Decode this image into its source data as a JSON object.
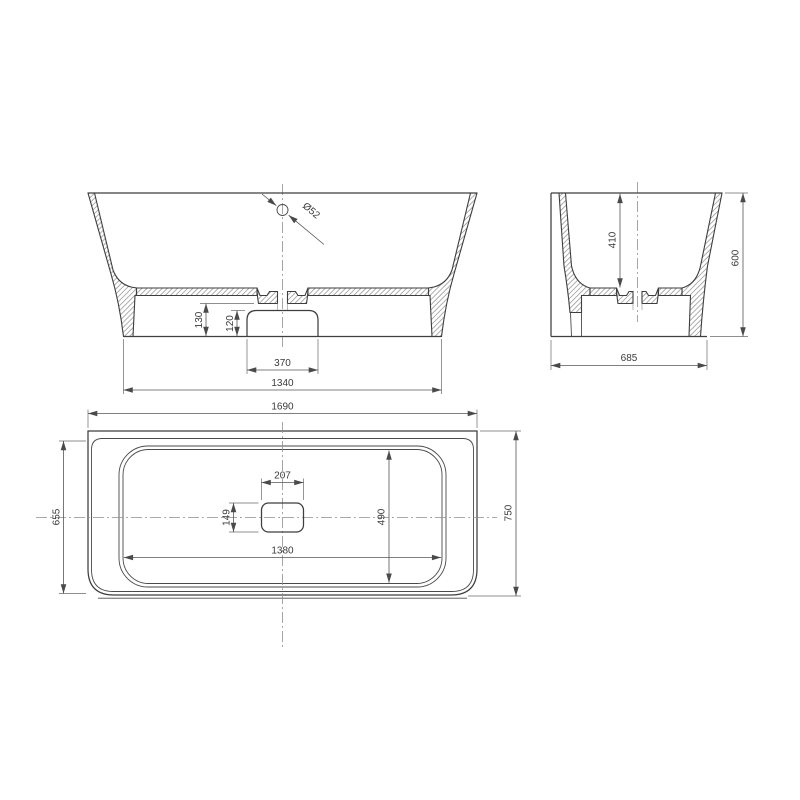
{
  "drawing": {
    "type": "bathtub-three-view-technical-drawing",
    "colors": {
      "line": "#3e3e3e",
      "dimension_line": "#555555",
      "centerline": "#8f8f8f",
      "plan_fill": "#e8eae9",
      "basin_fill": "#eceeed",
      "background": "#ffffff"
    },
    "front_view": {
      "drain_diameter": "Ø52",
      "sump_floor_height": "130",
      "pedestal_height": "120",
      "pedestal_width": "370",
      "base_width": "1340"
    },
    "side_view": {
      "inner_depth": "410",
      "overall_height": "600",
      "base_depth": "685"
    },
    "plan_view": {
      "overall_length": "1690",
      "rim_depth": "655",
      "overall_depth": "750",
      "drain_recess_length": "207",
      "drain_recess_width": "149",
      "basin_inner_depth": "490",
      "basin_inner_length": "1380"
    }
  }
}
